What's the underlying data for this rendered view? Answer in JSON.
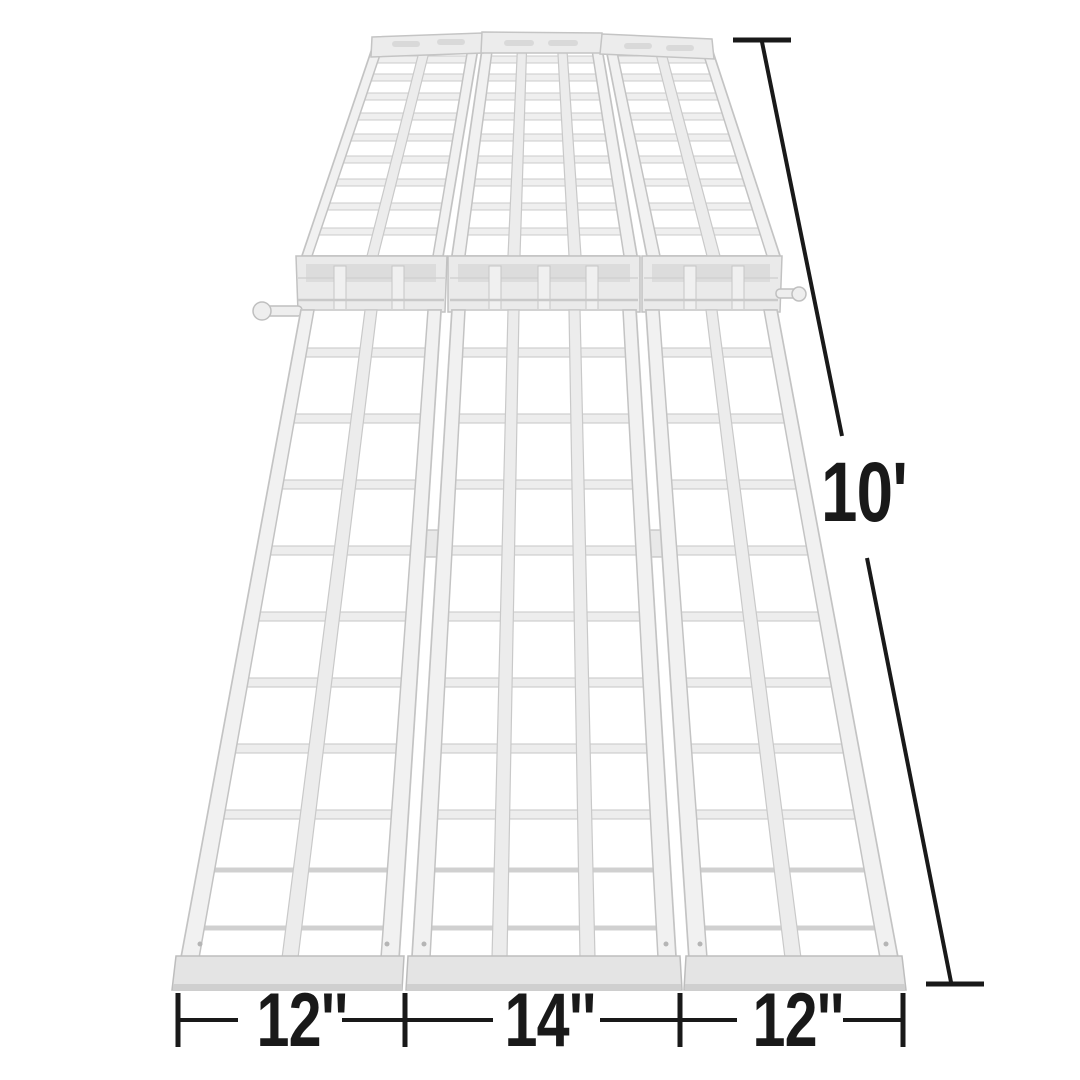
{
  "figure": {
    "subject": "tri-fold aluminum loading ramp",
    "background_color": "#ffffff"
  },
  "colors": {
    "dimension_annotation": "#191919",
    "ramp_metal_light": "#f1f1f1",
    "ramp_metal_outline": "#c8c8c8"
  },
  "dimensions": {
    "overall_height": {
      "label": "10'"
    },
    "bottom_widths": [
      {
        "label": "12''"
      },
      {
        "label": "14''"
      },
      {
        "label": "12''"
      }
    ]
  }
}
